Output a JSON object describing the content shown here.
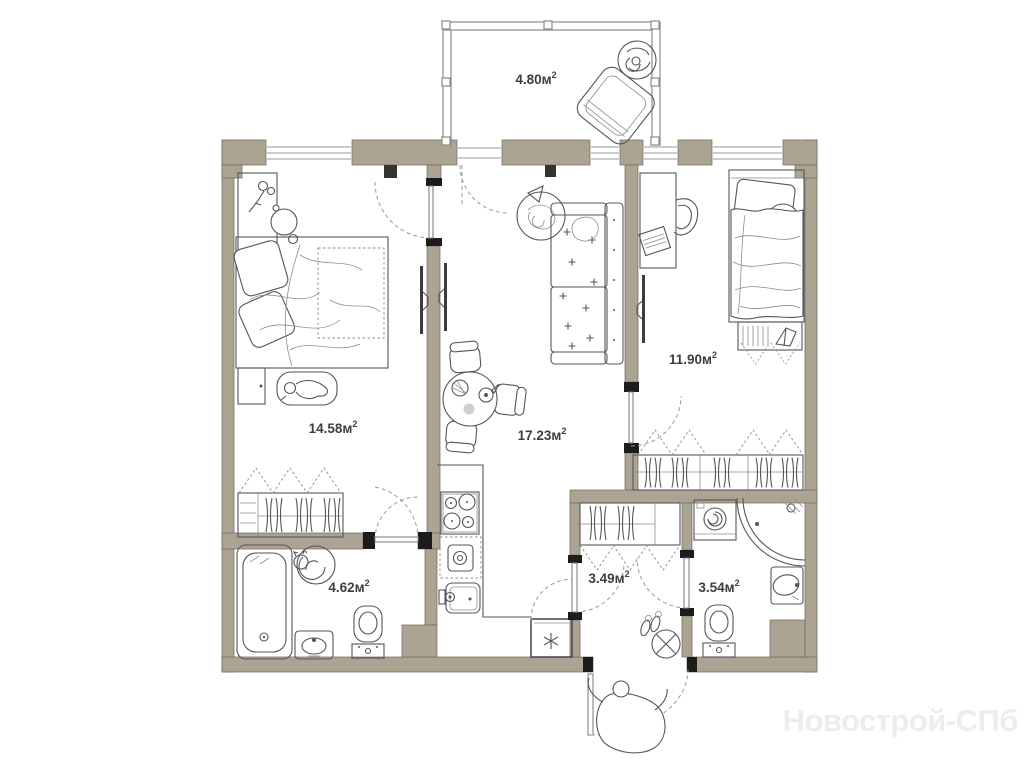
{
  "watermark": "Новострой-СПб",
  "unit_sup": "2",
  "rooms": {
    "balcony": {
      "area": "4.80м"
    },
    "bedroom_main": {
      "area": "14.58м"
    },
    "living_kitchen": {
      "area": "17.23м"
    },
    "bedroom_second": {
      "area": "11.90м"
    },
    "bathroom_main": {
      "area": "4.62м"
    },
    "hallway": {
      "area": "3.49м"
    },
    "bathroom_second": {
      "area": "3.54м"
    }
  },
  "colors": {
    "wall": "#aba493",
    "furniture_line": "#55555a",
    "label_text": "#3e3e40",
    "watermark_text": "#eeedee",
    "background": "#ffffff"
  }
}
